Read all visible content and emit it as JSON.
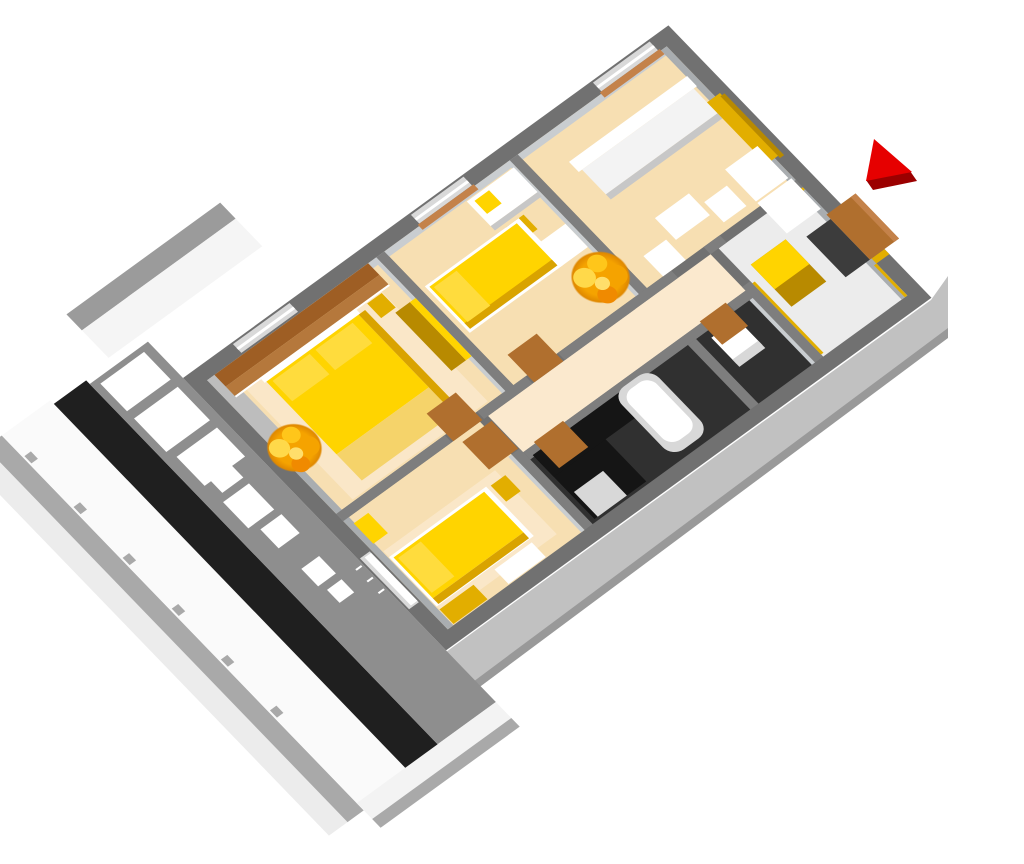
{
  "image_type": "3d-perspective-apartment-floor-plan-render",
  "background": "#FFFFFF",
  "colors": {
    "wallOuter": "#717171",
    "wallInner": "#7E7E7E",
    "wallFace": "#C9CDD0",
    "wallFaceDim": "#A9ADB0",
    "floor": "#F7DFB2",
    "floorLight": "#FBE9CE",
    "rug": "#FAE7C8",
    "hallFloor": "#ECECEC",
    "darkFloor": "#303030",
    "counter": "#151515",
    "washer": "#D8D8D8",
    "mat": "#3C3C3C",
    "yellow": "#FFD400",
    "yellowDeep": "#D9A300",
    "yellowPale": "#F5D36A",
    "pillow": "#FFDC3D",
    "gold": "#E2AE00",
    "goldDark": "#B88A00",
    "brownHi": "#B5783C",
    "brownLo": "#9E5E24",
    "door": "#B06F2E",
    "sill": "#C4824A",
    "glass": "#D9D9D9",
    "white": "#FFFFFF",
    "whiteSoft": "#F3F3F3",
    "furnSide": "#C7C7C7",
    "terraceFloor": "#8E8E8E",
    "terraceBlack": "#1F1F1F",
    "railWhite": "#FAFAFA",
    "railGray": "#A9A9A9",
    "railPale": "#ECECEC",
    "extGray": "#9B9B9B",
    "extWhite": "#F5F5F5",
    "facade": "#C1C1C1",
    "facadeDark": "#999999",
    "ledge": "#BDBDBD",
    "red": "#E60000",
    "redDark": "#9B0000"
  },
  "scene": {
    "marker": {
      "name": "entrance-direction-arrow",
      "color_key": "red",
      "points_at": "entrance-door"
    },
    "terrace": {
      "name": "terrace-balcony",
      "floor_color_key": "terraceFloor",
      "railing": "white panels with gray posts and pale outer rim",
      "furniture": [
        "outdoor-chair",
        "outdoor-table",
        "outdoor-chair",
        "outdoor-stool",
        "outdoor-stool"
      ]
    },
    "rooms": [
      {
        "name": "master-bedroom",
        "floor_color_key": "floor",
        "furniture": [
          "brown-wall-paneling",
          "double-bed-yellow",
          "pillow",
          "pillow",
          "bedside-table",
          "tall-wardrobe",
          "plant",
          "rug",
          "window-ledge"
        ]
      },
      {
        "name": "kids-bedroom",
        "floor_color_key": "floor",
        "furniture": [
          "single-bed-yellow",
          "pillow",
          "desk-white",
          "desk-lamp-yellow",
          "desk-chair-yellow",
          "side-table-white",
          "plant"
        ]
      },
      {
        "name": "living-room",
        "floor_color_key": "floor",
        "furniture": [
          "sofa-white",
          "coffee-table-white",
          "armchair-white",
          "armchair-white",
          "tv-cabinet-white",
          "gold-wall-panel"
        ]
      },
      {
        "name": "bedroom-2",
        "floor_color_key": "floor",
        "furniture": [
          "single-bed-yellow",
          "pillow",
          "bedside-table",
          "wardrobe-yellow",
          "dresser-white",
          "rug",
          "balcony-door"
        ]
      },
      {
        "name": "bathroom",
        "floor_color_key": "darkFloor",
        "furniture": [
          "bathtub-white",
          "black-vanity-counter",
          "washing-machine"
        ]
      },
      {
        "name": "wc",
        "floor_color_key": "darkFloor",
        "furniture": [
          "toilet-white"
        ]
      },
      {
        "name": "entrance-hall",
        "floor_color_key": "hallFloor",
        "furniture": [
          "tall-cabinet-yellow",
          "sideboard-white",
          "door-mat-dark",
          "entrance-door-brown",
          "yellow-baseboards"
        ]
      },
      {
        "name": "corridor",
        "floor_color_key": "floor",
        "furniture": [
          "door-brown-master",
          "door-brown-kids",
          "door-brown-bathroom",
          "door-brown-wc",
          "door-brown-bedroom2"
        ]
      }
    ],
    "windows": [
      "master-nw-window",
      "kids-nw-window",
      "living-nw-window"
    ]
  }
}
